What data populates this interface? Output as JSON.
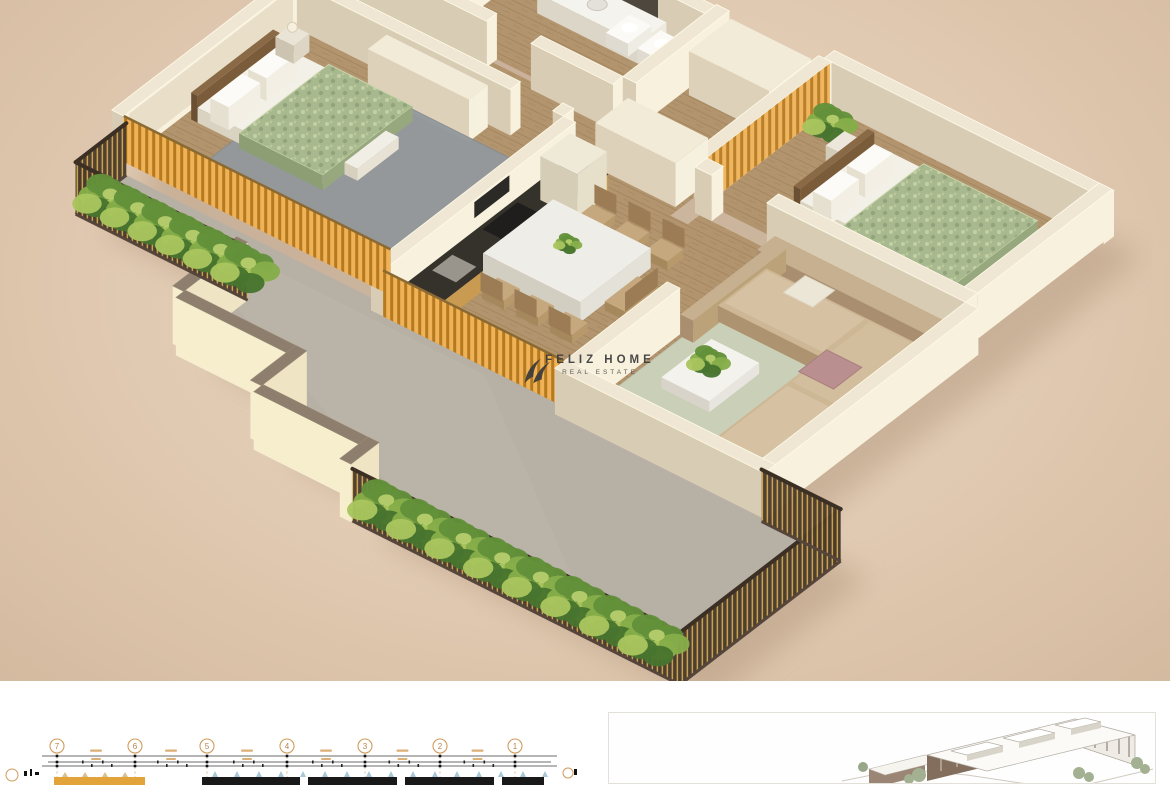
{
  "watermark": {
    "brand": "FELIZ HOME",
    "tagline": "REAL ESTATE"
  },
  "technical_drawing": {
    "grid_labels": [
      "7",
      "6",
      "5",
      "4",
      "3",
      "2",
      "1"
    ]
  },
  "palette": {
    "background": "#e1cab2",
    "wall_top": "#efe7d3",
    "wall_lit": "#f8f1de",
    "wall_shadow": "#d9ccb4",
    "wood_floor": "#b2946e",
    "accent_wood": "#f0b257",
    "railing_dark": "#4a3b2c",
    "railing_gold": "#c9a04e",
    "terrace_floor": "#b7b0a5",
    "parapet_cream": "#f6eecd",
    "parapet_top": "#8d7e6d",
    "plant_green": "#63913a",
    "duvet_green": "#a9b98f",
    "sofa_beige": "#c7b08f",
    "rug_gray": "#93999d",
    "rug_sage": "#ccd3bd",
    "logo_color": "#3a3a3a",
    "tech_accent": "#cf9c5c",
    "tech_dark": "#191919",
    "tech_blue": "#9fc2d4",
    "building_brown": "#836d5c"
  }
}
